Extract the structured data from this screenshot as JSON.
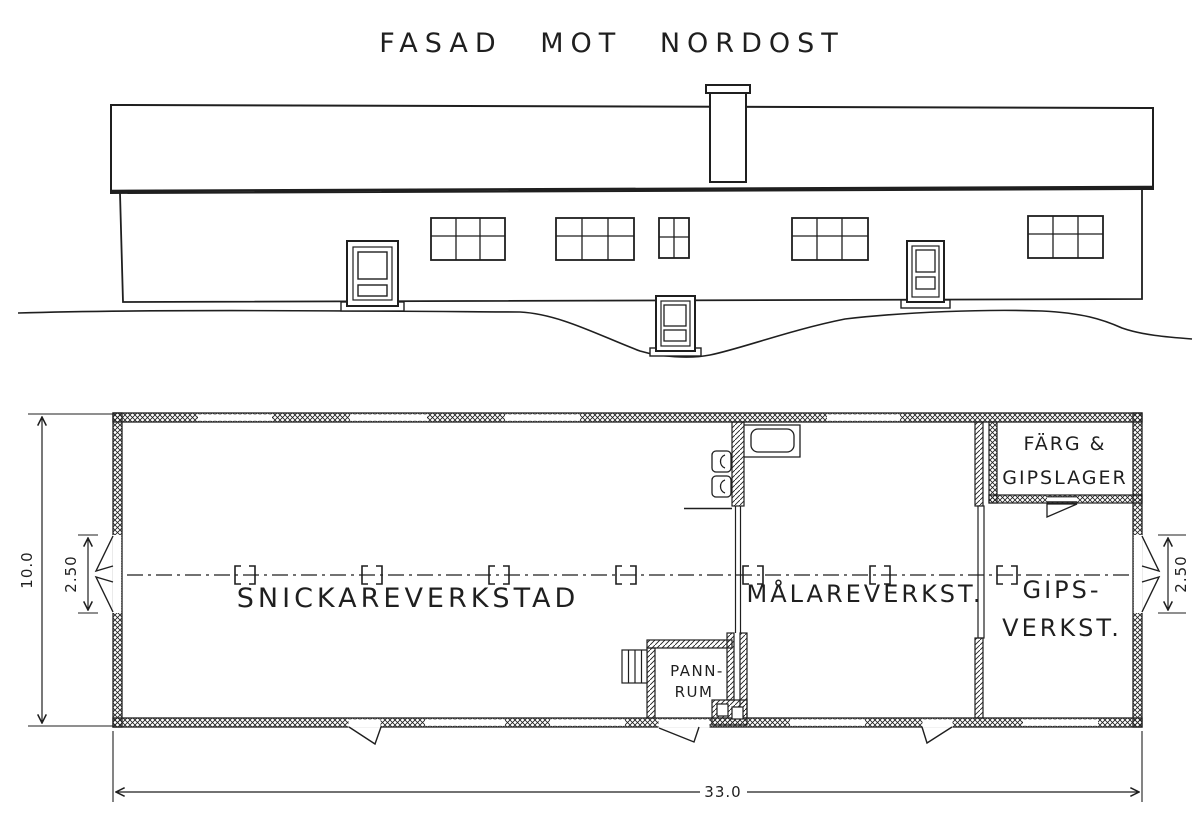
{
  "title": "FASAD MOT NORDOST",
  "colors": {
    "ink": "#1f1f1f",
    "paper": "#ffffff"
  },
  "floor_plan": {
    "room_labels": {
      "snickareverkstad": "SNICKAREVERKSTAD",
      "malareverkstad": "MÅLAREVERKST.",
      "gipsverkstad": [
        "GIPS-",
        "VERKST."
      ],
      "farg_gipslager": [
        "FÄRG &",
        "GIPSLAGER"
      ],
      "pannrum": [
        "PANN-",
        "RUM"
      ]
    },
    "dimensions": {
      "total_length": "33.0",
      "total_width": "10.0",
      "left_opening": "2.50",
      "right_opening": "2.50"
    }
  }
}
